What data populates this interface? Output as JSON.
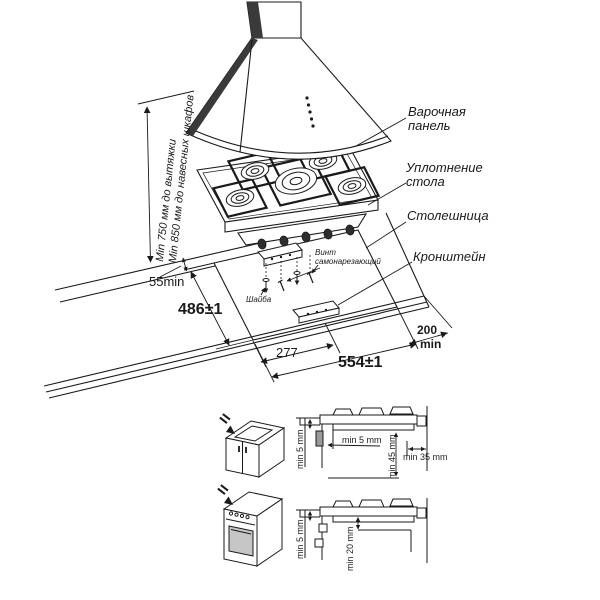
{
  "diagram": {
    "callouts": {
      "hob": "Варочная панель",
      "seal": "Уплотнение стола",
      "countertop": "Столешница",
      "bracket": "Кронштейн",
      "screw": "Винт самонарезающий",
      "washer": "Шайба"
    },
    "clearances": {
      "hood": "Min 750 мм до вытяжки",
      "cabinets": "Min 850 мм до навесных шкафов"
    },
    "cutout_dims": {
      "wall_gap": "55min",
      "depth": "486±1",
      "center": "277",
      "width": "554±1",
      "right_gap_value": "200",
      "right_gap_unit": "min"
    },
    "section_top": {
      "edge_gap": "min 5 mm",
      "front_gap": "min 5 mm",
      "below_clearance": "min 45 mm",
      "side_clearance": "min 35 mm"
    },
    "section_bottom": {
      "edge_gap": "min 5 mm",
      "below_clearance": "min 20 mm"
    },
    "colors": {
      "line": "#1a1a1a",
      "dark_fill": "#3a3a3a",
      "oven_door": "#c6c6c6",
      "panel_gray": "#9a9a9a"
    }
  }
}
